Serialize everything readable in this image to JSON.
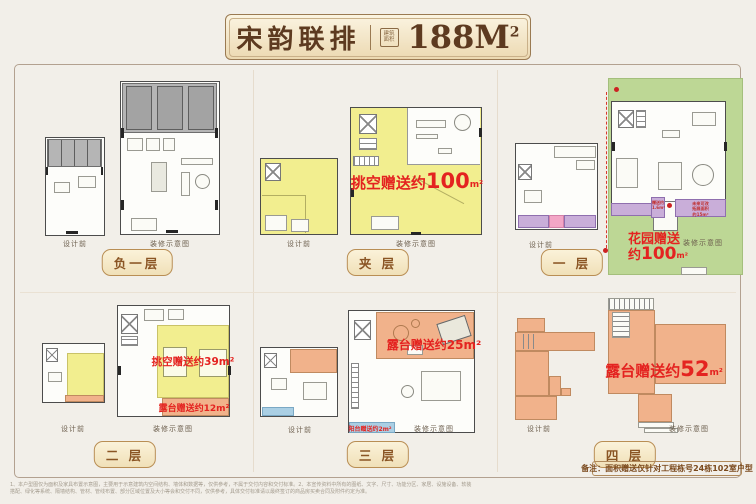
{
  "title": {
    "name": "宋韵联排",
    "seal_line1": "建筑",
    "seal_line2": "面积",
    "area_value": "188M",
    "area_sup": "2"
  },
  "panels": [
    {
      "label": "负一层",
      "left_caption": "设计前",
      "right_caption": "装修示意图"
    },
    {
      "label": "夹 层",
      "left_caption": "设计前",
      "right_caption": "装修示意图",
      "hollow": {
        "prefix": "挑空赠送约",
        "value": "100",
        "unit": "m²"
      }
    },
    {
      "label": "一 层",
      "left_caption": "设计前",
      "right_caption": "装修示意图",
      "garden": {
        "line1": "花园赠送",
        "prefix": "约",
        "value": "100",
        "unit": "m²"
      },
      "gift": {
        "line1": "赠送约",
        "line2": "1.6m²"
      },
      "expand": {
        "line1": "未来可改",
        "line2": "拓展面积",
        "line3": "约15m²"
      }
    },
    {
      "label": "二 层",
      "left_caption": "设计前",
      "right_caption": "装修示意图",
      "hollow_text": "挑空赠送约39m²",
      "terrace_text": "露台赠送约12m²"
    },
    {
      "label": "三 层",
      "left_caption": "设计前",
      "right_caption": "装修示意图",
      "terrace_text": "露台赠送约25m²",
      "balcony_text": "阳台赠送约2m²"
    },
    {
      "label": "四 层",
      "left_caption": "设计前",
      "right_caption": "装修示意图",
      "terrace": {
        "prefix": "露台赠送约",
        "value": "52",
        "unit": "m²"
      }
    }
  ],
  "note": "备注：面积赠送仅针对工程栋号24栋102室户型",
  "disclaimer_line1": "1、本户型图仅为面积及家具布置示意图，主要用于示意建筑内空间结构、墙体和数据等，仅供参考，不属于交付内容和交付标准。2、本宣传资料中所有的图纸、文字、尺寸、功能分区、家居、设施设备、软装",
  "disclaimer_line2": "搭配、绿化等系统、隔墙结构、管材、管线布置、部分区域位置及大小等会和交付不同，仅供参考，具体交付标准请以最终签订的商品房买卖合同及附件约定为准。",
  "colors": {
    "highlight_yellow": "#f2ee8f",
    "terrace_orange": "#f1b28b",
    "garden_green": "#bdd795",
    "gift_purple": "#c9aed9",
    "accent_pink": "#f3a6c6",
    "balcony_blue": "#aacfe4",
    "annotation_red": "#e42320",
    "badge_brown": "#8a5524"
  }
}
